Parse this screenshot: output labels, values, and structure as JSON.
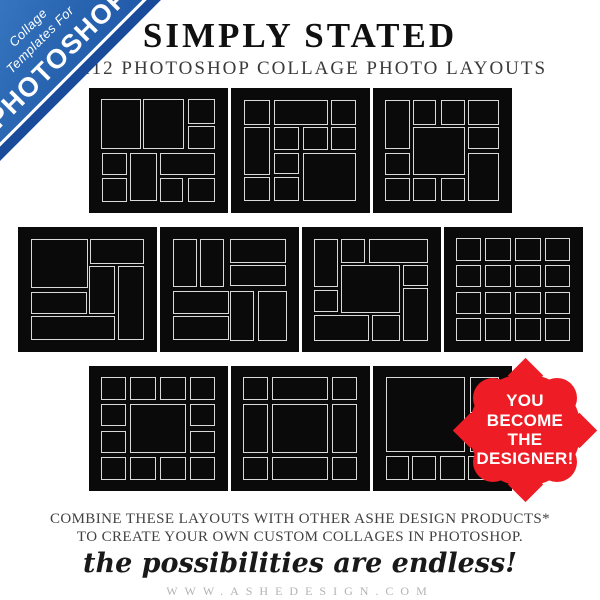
{
  "ribbon": {
    "line1": "Collage",
    "line2": "Templates For",
    "brand": "PHOTOSHOP",
    "bg_color": "#2a66b2",
    "edge_color": "#1a4b9b",
    "text_color": "#ffffff"
  },
  "header": {
    "title": "SIMPLY STATED",
    "subtitle": "12X12 PHOTOSHOP COLLAGE PHOTO LAYOUTS"
  },
  "badge": {
    "lines": [
      "YOU",
      "BECOME",
      "THE",
      "DESIGNER!"
    ],
    "color": "#ee1c24",
    "text_color": "#ffffff"
  },
  "footer": {
    "line1": "COMBINE THESE LAYOUTS WITH OTHER ASHE DESIGN PRODUCTS*",
    "line2": "TO CREATE YOUR OWN CUSTOM COLLAGES IN PHOTOSHOP.",
    "tagline": "the possibilities are endless!",
    "url": "WWW.ASHEDESIGN.COM"
  },
  "thumb_style": {
    "bg": "#0a0a0a",
    "cell_border": "#d9d9d9"
  },
  "collage_rows": [
    [
      0,
      1,
      2
    ],
    [
      3,
      4,
      5,
      6
    ],
    [
      7,
      8,
      9
    ]
  ],
  "collages": [
    {
      "name": "layout-1",
      "cells": [
        [
          0,
          0,
          35,
          49
        ],
        [
          37,
          0,
          36,
          49
        ],
        [
          76,
          0,
          24,
          24
        ],
        [
          76,
          26,
          24,
          23
        ],
        [
          1,
          52,
          22,
          22
        ],
        [
          1,
          77,
          22,
          23
        ],
        [
          26,
          52,
          23,
          47
        ],
        [
          52,
          52,
          48,
          22
        ],
        [
          52,
          77,
          20,
          23
        ],
        [
          76,
          77,
          24,
          23
        ]
      ]
    },
    {
      "name": "layout-2",
      "cells": [
        [
          1,
          1,
          23,
          24
        ],
        [
          27,
          1,
          47,
          24
        ],
        [
          77,
          1,
          22,
          24
        ],
        [
          1,
          27,
          23,
          47
        ],
        [
          27,
          27,
          22,
          23
        ],
        [
          53,
          27,
          21,
          23
        ],
        [
          77,
          27,
          22,
          23
        ],
        [
          27,
          52,
          22,
          21
        ],
        [
          53,
          52,
          46,
          47
        ],
        [
          1,
          76,
          23,
          23
        ],
        [
          27,
          76,
          22,
          23
        ]
      ]
    },
    {
      "name": "layout-3",
      "cells": [
        [
          0,
          1,
          22,
          48
        ],
        [
          25,
          1,
          20,
          24
        ],
        [
          49,
          1,
          21,
          24
        ],
        [
          73,
          1,
          27,
          24
        ],
        [
          73,
          27,
          27,
          22
        ],
        [
          25,
          27,
          45,
          47
        ],
        [
          0,
          52,
          22,
          22
        ],
        [
          73,
          52,
          27,
          47
        ],
        [
          0,
          77,
          22,
          22
        ],
        [
          25,
          77,
          20,
          22
        ],
        [
          49,
          77,
          21,
          22
        ]
      ]
    },
    {
      "name": "layout-4",
      "cells": [
        [
          1,
          1,
          50,
          48
        ],
        [
          53,
          1,
          47,
          24
        ],
        [
          52,
          27,
          22,
          47
        ],
        [
          77,
          27,
          23,
          72
        ],
        [
          1,
          52,
          49,
          22
        ],
        [
          1,
          76,
          73,
          23
        ]
      ]
    },
    {
      "name": "layout-5",
      "cells": [
        [
          1,
          1,
          21,
          47
        ],
        [
          25,
          1,
          21,
          47
        ],
        [
          51,
          1,
          49,
          23
        ],
        [
          51,
          26,
          49,
          21
        ],
        [
          1,
          51,
          49,
          23
        ],
        [
          1,
          76,
          49,
          23
        ],
        [
          51,
          51,
          21,
          49
        ],
        [
          75,
          51,
          25,
          49
        ]
      ]
    },
    {
      "name": "layout-6",
      "cells": [
        [
          0,
          1,
          21,
          47
        ],
        [
          24,
          1,
          21,
          23
        ],
        [
          48,
          1,
          52,
          23
        ],
        [
          24,
          26,
          51,
          47
        ],
        [
          78,
          26,
          22,
          21
        ],
        [
          78,
          49,
          22,
          51
        ],
        [
          0,
          50,
          21,
          22
        ],
        [
          0,
          75,
          48,
          25
        ],
        [
          51,
          75,
          24,
          25
        ]
      ]
    },
    {
      "name": "layout-7",
      "cells": [
        [
          0,
          0,
          22,
          22
        ],
        [
          26,
          0,
          22,
          22
        ],
        [
          52,
          0,
          22,
          22
        ],
        [
          78,
          0,
          22,
          22
        ],
        [
          0,
          26,
          22,
          22
        ],
        [
          26,
          26,
          22,
          22
        ],
        [
          52,
          26,
          22,
          22
        ],
        [
          78,
          26,
          22,
          22
        ],
        [
          0,
          52,
          22,
          22
        ],
        [
          26,
          52,
          22,
          22
        ],
        [
          52,
          52,
          22,
          22
        ],
        [
          78,
          52,
          22,
          22
        ],
        [
          0,
          78,
          22,
          22
        ],
        [
          26,
          78,
          22,
          22
        ],
        [
          52,
          78,
          22,
          22
        ],
        [
          78,
          78,
          22,
          22
        ]
      ]
    },
    {
      "name": "layout-8",
      "cells": [
        [
          0,
          0,
          22,
          22
        ],
        [
          26,
          0,
          22,
          22
        ],
        [
          52,
          0,
          22,
          22
        ],
        [
          78,
          0,
          22,
          22
        ],
        [
          0,
          26,
          22,
          22
        ],
        [
          78,
          26,
          22,
          22
        ],
        [
          26,
          26,
          48,
          48
        ],
        [
          0,
          52,
          22,
          22
        ],
        [
          78,
          52,
          22,
          22
        ],
        [
          0,
          78,
          22,
          22
        ],
        [
          26,
          78,
          22,
          22
        ],
        [
          52,
          78,
          22,
          22
        ],
        [
          78,
          78,
          22,
          22
        ]
      ]
    },
    {
      "name": "layout-9",
      "cells": [
        [
          0,
          0,
          22,
          22
        ],
        [
          26,
          0,
          48,
          22
        ],
        [
          78,
          0,
          22,
          22
        ],
        [
          0,
          26,
          22,
          48
        ],
        [
          26,
          26,
          48,
          48
        ],
        [
          78,
          26,
          22,
          48
        ],
        [
          0,
          78,
          22,
          22
        ],
        [
          26,
          78,
          48,
          22
        ],
        [
          78,
          78,
          22,
          22
        ]
      ]
    },
    {
      "name": "layout-10",
      "cells": [
        [
          1,
          0,
          69,
          73
        ],
        [
          74,
          0,
          26,
          35
        ],
        [
          74,
          38,
          26,
          35
        ],
        [
          1,
          77,
          20,
          23
        ],
        [
          24,
          77,
          21,
          23
        ],
        [
          48,
          77,
          22,
          23
        ],
        [
          73,
          77,
          22,
          23
        ]
      ]
    }
  ]
}
